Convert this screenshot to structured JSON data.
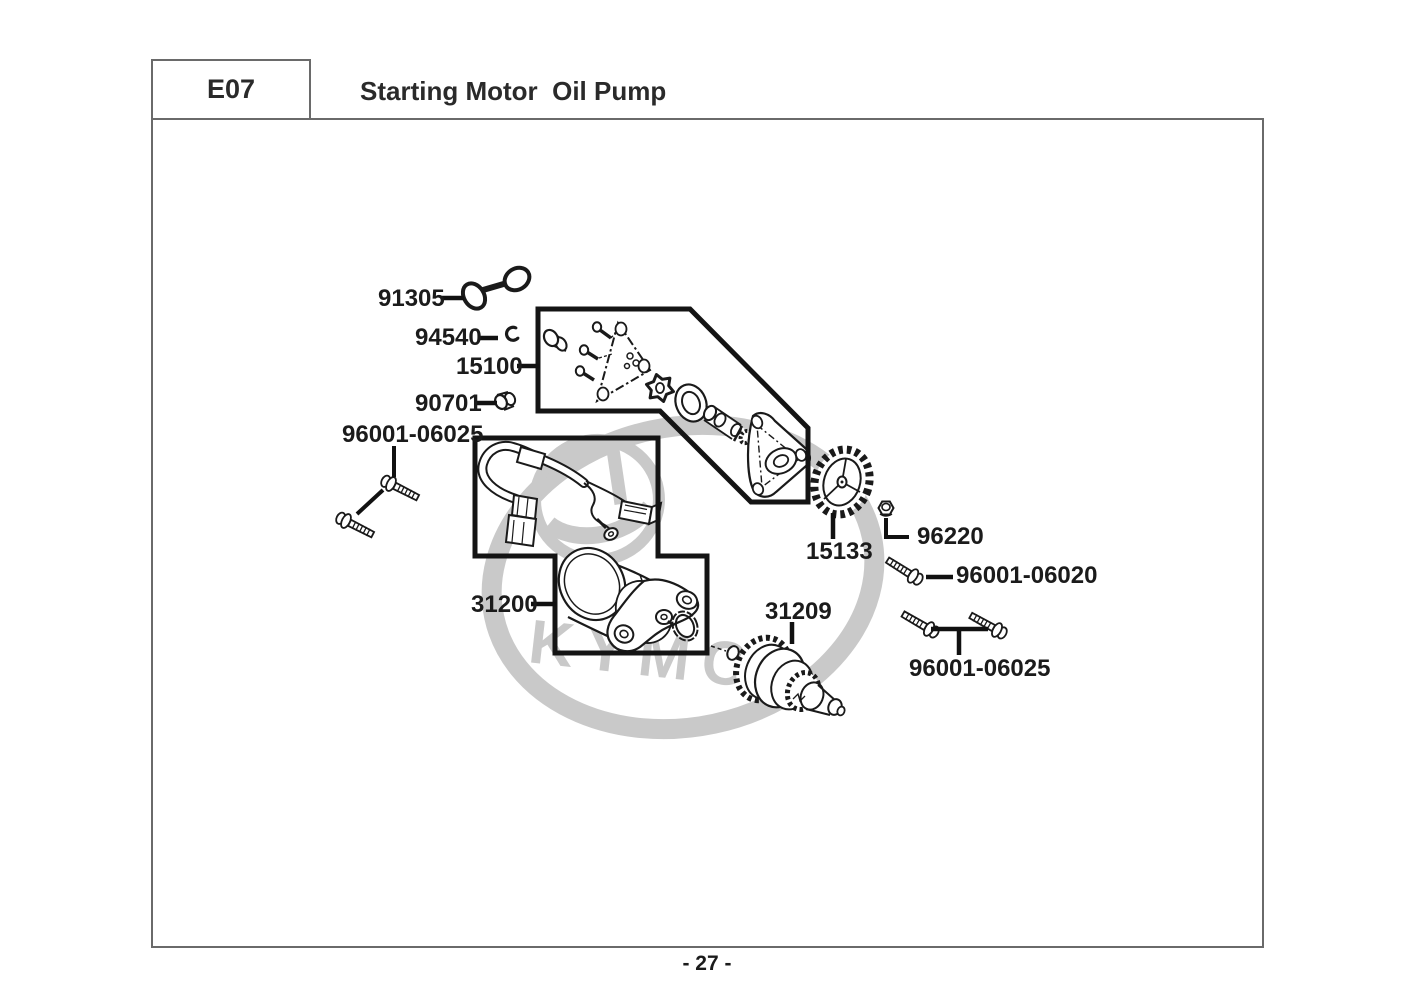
{
  "header": {
    "section_code": "E07",
    "title": "Starting Motor  Oil Pump"
  },
  "footer": {
    "page_number": "- 27 -"
  },
  "watermark": {
    "brand": "KYMCO",
    "color": "#c9c9c9"
  },
  "colors": {
    "line_art": "#1a1a1a",
    "border": "#6a6a6a",
    "box_outline": "#141414"
  },
  "parts": [
    {
      "part_no": "91305"
    },
    {
      "part_no": "94540"
    },
    {
      "part_no": "15100"
    },
    {
      "part_no": "90701"
    },
    {
      "part_no": "96001-06025"
    },
    {
      "part_no": "31200"
    },
    {
      "part_no": "31209"
    },
    {
      "part_no": "15133"
    },
    {
      "part_no": "96220"
    },
    {
      "part_no": "96001-06020"
    },
    {
      "part_no": "96001-06025"
    }
  ]
}
